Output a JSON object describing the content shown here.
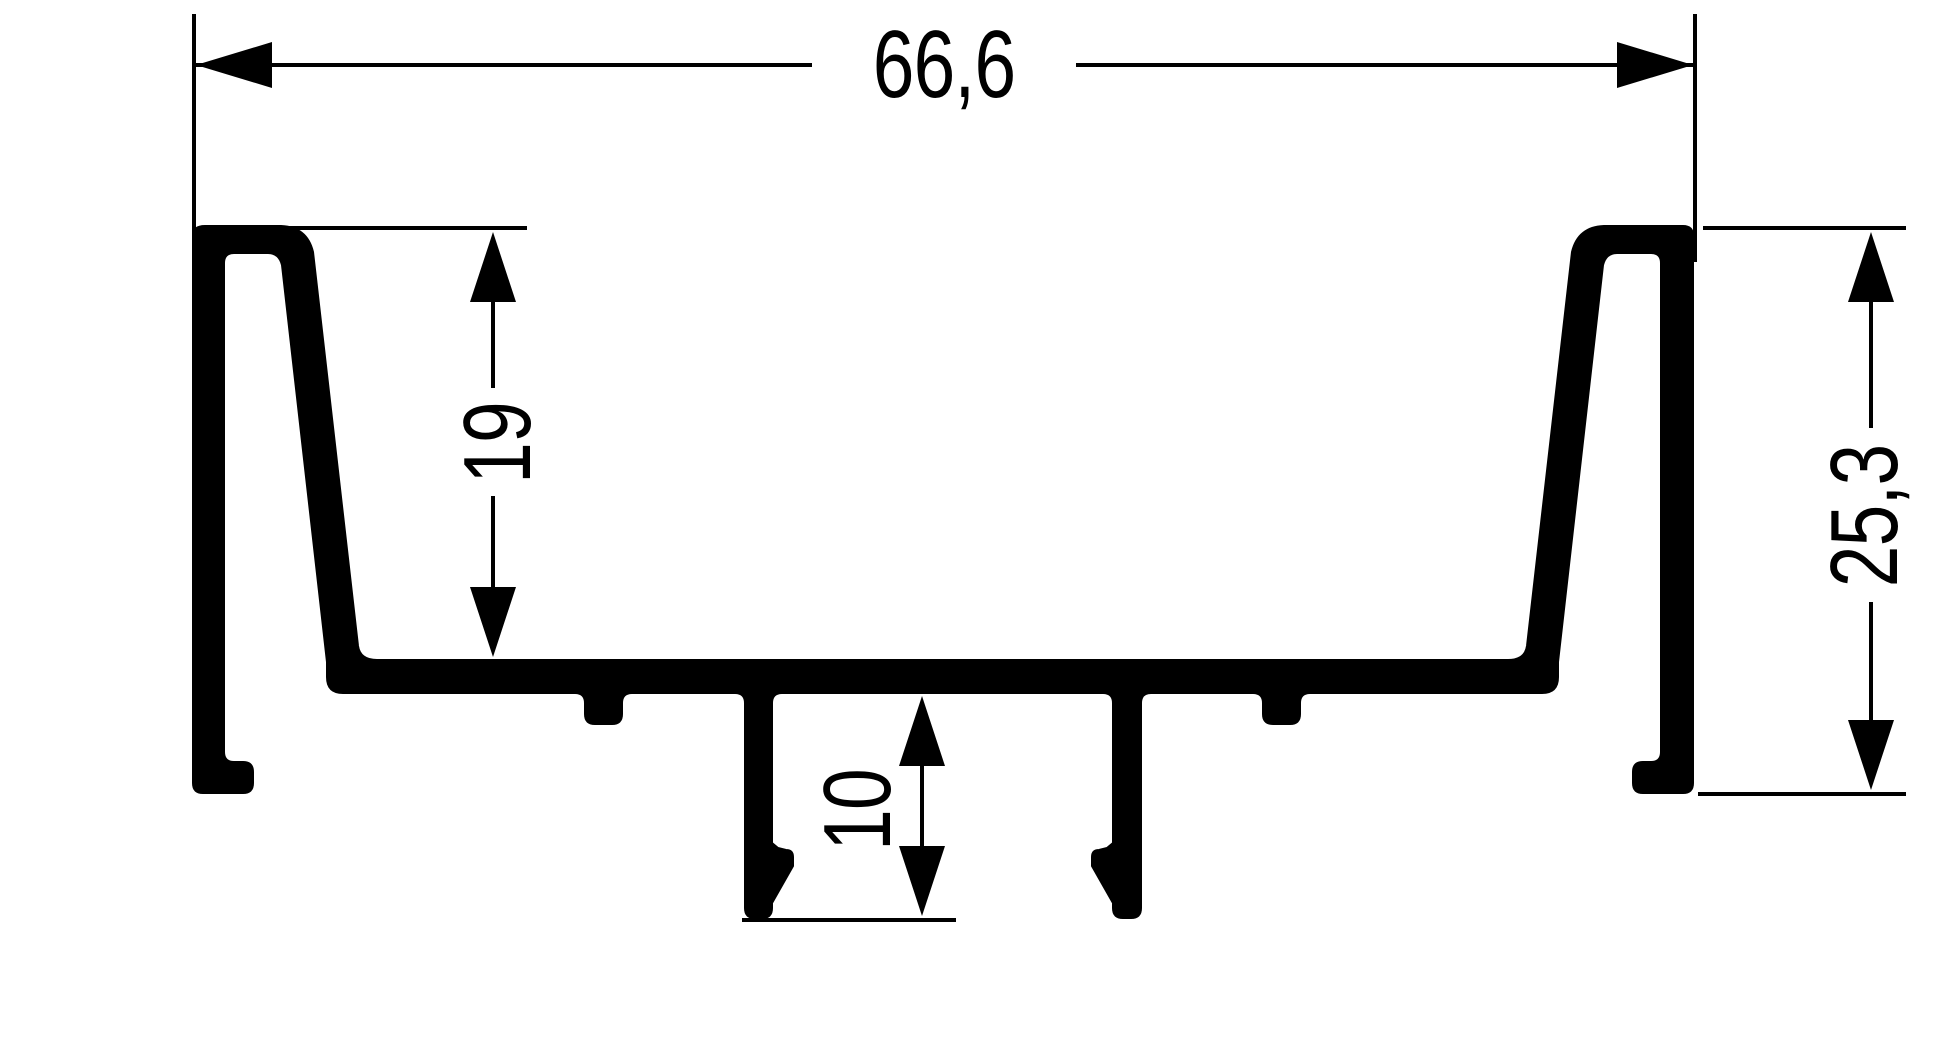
{
  "drawing": {
    "kind": "technical-profile-cross-section",
    "ink_color": "#000000",
    "background_color": "#ffffff",
    "dimensions": {
      "overall_width": {
        "label": "66,6",
        "orientation": "horizontal"
      },
      "inner_depth": {
        "label": "19",
        "orientation": "vertical"
      },
      "overall_height": {
        "label": "25,3",
        "orientation": "vertical"
      },
      "leg_depth": {
        "label": "10",
        "orientation": "vertical"
      }
    }
  }
}
